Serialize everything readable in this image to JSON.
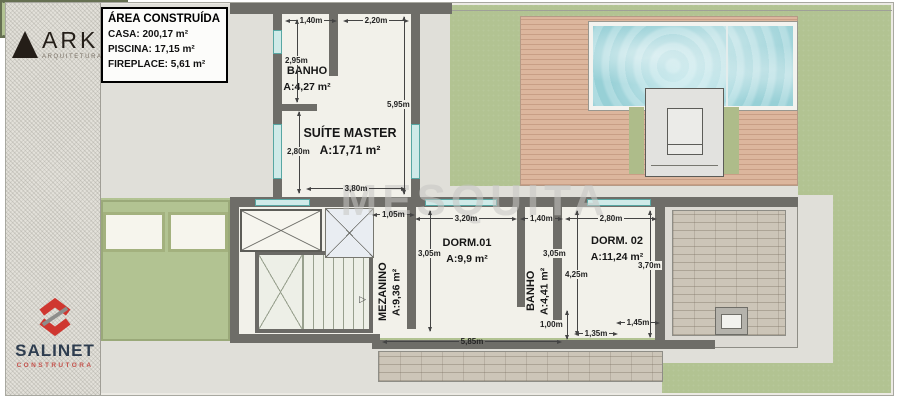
{
  "branding": {
    "ark": {
      "name": "ARK",
      "tagline": "ARQUITETURA"
    },
    "salinet": {
      "name": "SALINET",
      "tagline": "CONSTRUTORA"
    }
  },
  "area_table": {
    "title": "ÁREA CONSTRUÍDA",
    "rows": [
      "CASA: 200,17 m²",
      "PISCINA: 17,15 m²",
      "FIREPLACE: 5,61 m²"
    ]
  },
  "watermark": {
    "text": "MESQUITA"
  },
  "rooms": [
    {
      "name": "BANHO",
      "area": "A:4,27 m²"
    },
    {
      "name": "SUÍTE MASTER",
      "area": "A:17,71 m²"
    },
    {
      "name": "MEZANINO",
      "area": "A:9,36 m²"
    },
    {
      "name": "DORM.01",
      "area": "A:9,9 m²"
    },
    {
      "name": "BANHO",
      "area": "A:4,41 m²"
    },
    {
      "name": "DORM. 02",
      "area": "A:11,24 m²"
    }
  ],
  "dims": {
    "h": [
      "1,40m",
      "2,20m",
      "3,80m",
      "1,05m",
      "3,20m",
      "1,40m",
      "2,80m",
      "1,45m",
      "1,35m",
      "5,85m"
    ],
    "v": [
      "2,95m",
      "5,95m",
      "2,80m",
      "3,05m",
      "3,05m",
      "4,25m",
      "3,70m",
      "1,00m"
    ]
  },
  "colors": {
    "grass": "#b2c392",
    "wall": "#6e6d68",
    "floor": "#f2f1ea",
    "pool_water": "#9fd4da",
    "deck_wood": "#dcb69d",
    "window": "#cfeae8",
    "logo_red": "#cf3730",
    "logo_navy": "#2e3d4f",
    "ink": "#111111"
  }
}
